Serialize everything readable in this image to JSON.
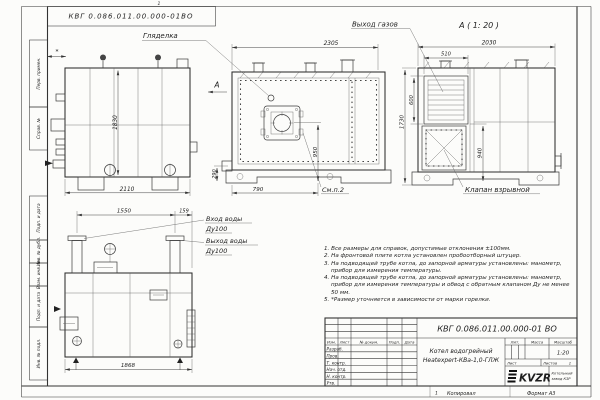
{
  "frame": {
    "designation_top": "КВГ 0.086.011.00.000-01ВО",
    "zone_top": "1",
    "zone_bottom": "1",
    "copied_label": "Копировал",
    "format_label": "Формат А3",
    "margin_labels": [
      "Перв. примен.",
      "Справ. №",
      "Подп. и дата",
      "Инв. № дубл.",
      "Взам. инв. №",
      "Подп. и дата",
      "Инв. № подл."
    ]
  },
  "views": {
    "side": {
      "dim_height": "1830",
      "dim_width": "2110",
      "dim_star": "*",
      "section_arrow": "А"
    },
    "front": {
      "sight_label": "Гляделка",
      "dim_width": "2305",
      "dim_burner_height": "950",
      "dim_burner_offset": "790",
      "dim_base": "290",
      "see_note": "См.п.2"
    },
    "section_a": {
      "title": "А ( 1: 20 )",
      "gas_outlet_label": "Выход газов",
      "dim_width": "2030",
      "dim_vent_width": "510",
      "dim_vent_height": "600",
      "dim_height": "1730",
      "dim_valve_height": "940",
      "valve_label": "Клапан взрывной"
    },
    "rear": {
      "dim_span": "1550",
      "dim_offset": "159",
      "inlet_label": "Вход воды",
      "inlet_dn": "Ду100",
      "outlet_label": "Выход воды",
      "outlet_dn": "Ду100",
      "dim_width": "1868"
    }
  },
  "notes": [
    "1. Все размеры для справок, допустимые отклонения ±100мм.",
    "2. На фронтовой плите котла установлен пробоотборный штуцер.",
    "3. На подводящей трубе котла, до запорной арматуры установлены: манометр, прибор для измерения температуры.",
    "4. На подводящей трубе котла, до запорной арматуры установлены: манометр, прибор для измерения температуры и обвод с обратным клапаном Ду не менее 50 мм.",
    "5. *Размер уточняется в зависимости от марки горелки."
  ],
  "title_block": {
    "designation": "КВГ 0.086.011.00.000-01 ВО",
    "product_line1": "Котел водогрейный",
    "product_line2": "Heatexpert-КВа-1,0-ГЛЖ",
    "col_izm": "Изм.",
    "col_list": "Лист",
    "col_doc": "№ докум.",
    "col_sign": "Подп.",
    "col_date": "Дата",
    "row_labels": [
      "Разраб.",
      "Пров.",
      "Т. контр.",
      "Нач. отд.",
      "Н. контр.",
      "Утв."
    ],
    "lit_label": "Лит.",
    "mass_label": "Масса",
    "scale_label": "Масштаб",
    "scale_value": "1:20",
    "sheet_label": "Лист",
    "sheets_label": "Листов",
    "sheets_value": "1",
    "logo_text": "KVZR",
    "logo_caption1": "Котельный",
    "logo_caption2": "завод КЗР"
  }
}
